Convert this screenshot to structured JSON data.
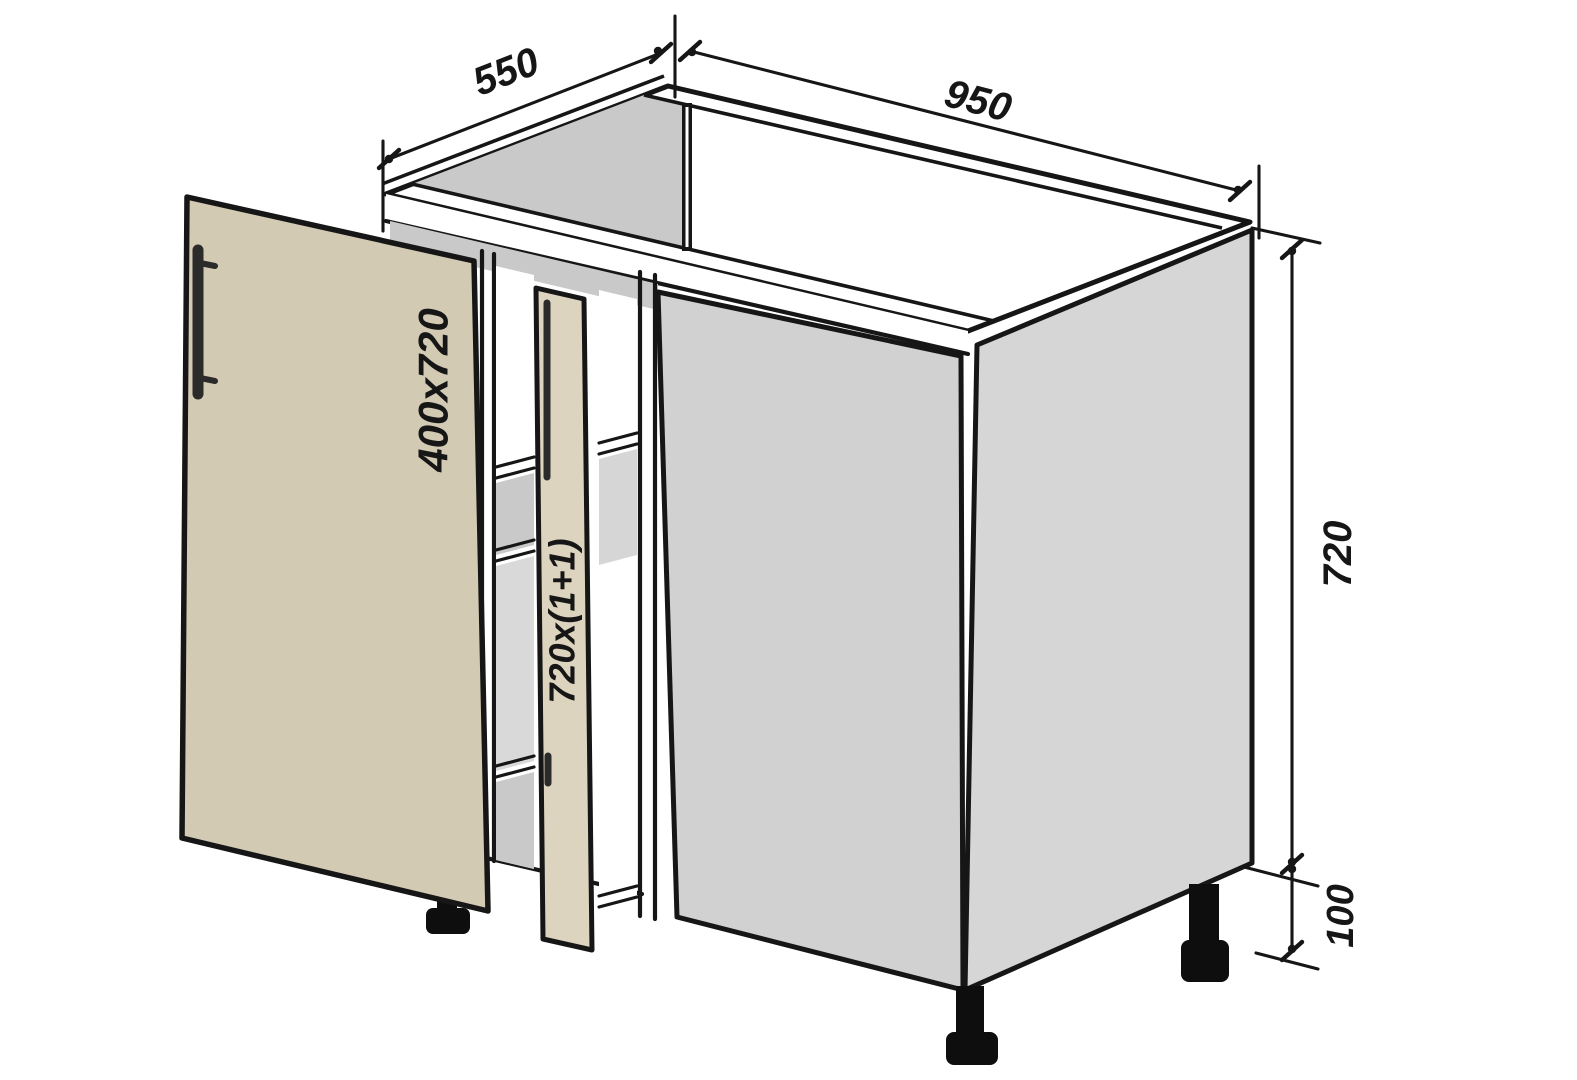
{
  "diagram": {
    "labels": {
      "depth": "550",
      "width": "950",
      "height": "720",
      "leg_height": "100",
      "door_size": "400x720",
      "facade_size": "720x(1+1)"
    },
    "colors": {
      "background": "#ffffff",
      "door": "#d3cab4",
      "facade_strip": "#ddd4bf",
      "front_panel": "#d1d1d1",
      "side_panel": "#d6d6d6",
      "interior_shadow": "#c9c9c9",
      "line": "#161616"
    }
  }
}
